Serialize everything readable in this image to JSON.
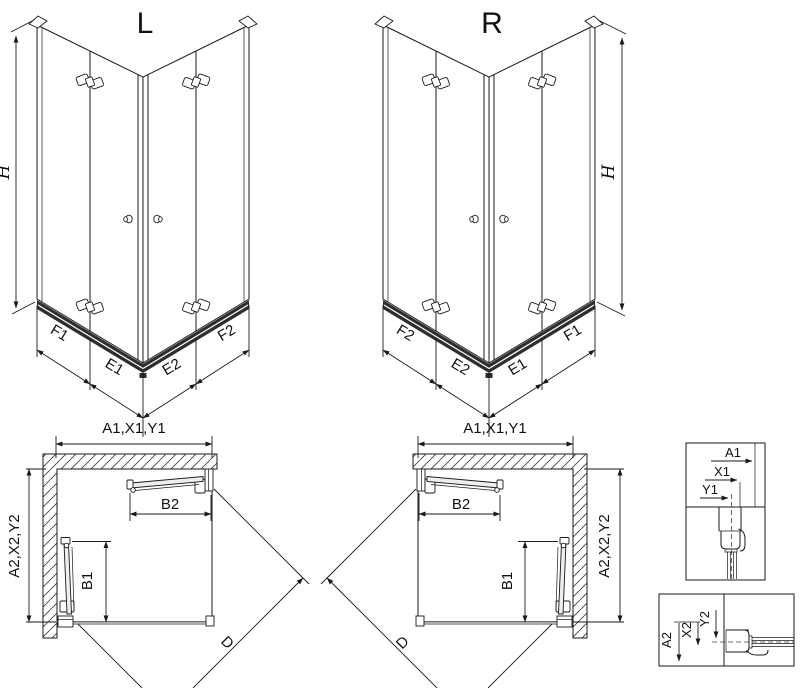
{
  "iso_left": {
    "label": "L",
    "height_label": "H",
    "bottom_labels": [
      "F1",
      "E1",
      "E2",
      "F2"
    ]
  },
  "iso_right": {
    "label": "R",
    "height_label": "H",
    "bottom_labels": [
      "F2",
      "E2",
      "E1",
      "F1"
    ]
  },
  "plan_left": {
    "top_dim": "A1,X1,Y1",
    "side_dim": "A2,X2,Y2",
    "top_door_dim": "B2",
    "side_door_dim": "B1",
    "diagonal_dim": "D"
  },
  "plan_right": {
    "top_dim": "A1,X1,Y1",
    "side_dim": "A2,X2,Y2",
    "top_door_dim": "B2",
    "side_door_dim": "B1",
    "diagonal_dim": "D"
  },
  "detail_top": {
    "dims": [
      "A1",
      "X1",
      "Y1"
    ]
  },
  "detail_bottom": {
    "dims": [
      "A2",
      "X2",
      "Y2"
    ]
  },
  "colors": {
    "line": "#1a1a1a",
    "rail": "#2e2e2e",
    "threshold": "#aaaaaa"
  }
}
